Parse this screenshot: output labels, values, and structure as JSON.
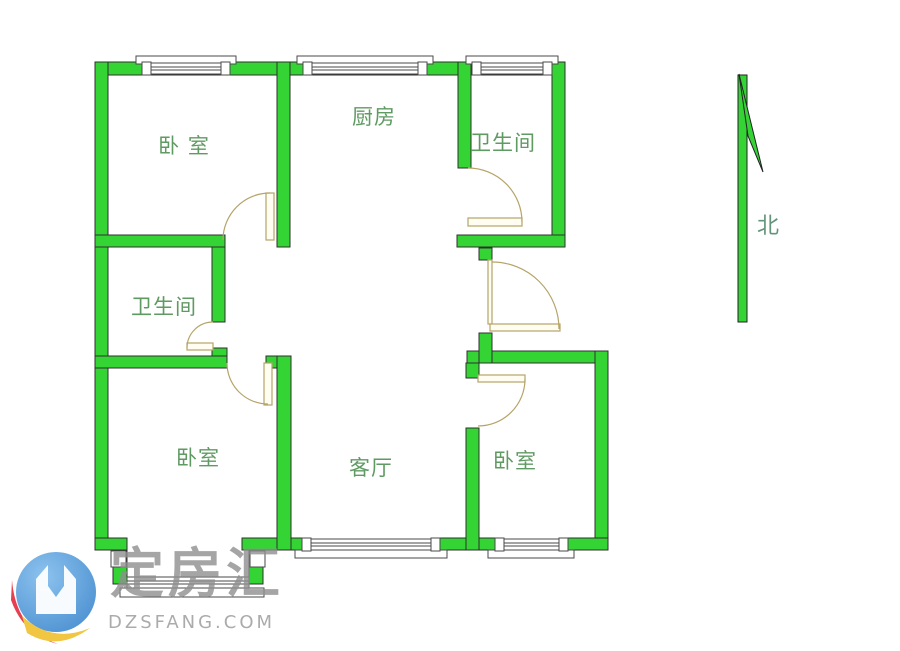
{
  "meta": {
    "title": "apartment-floor-plan",
    "width": 900,
    "height": 651
  },
  "theme": {
    "wall_fill": "#35d435",
    "wall_stroke": "#2f2f2f",
    "door_color": "#b5a468",
    "window_stroke": "#4a4a4a",
    "label_color": "#5f9a62",
    "north_color": "#64947c",
    "logo_blue": "#5b9fd8",
    "logo_blue_light": "#8cc2ee",
    "logo_red": "#e64050",
    "logo_yellow": "#f0c643",
    "watermark_gray": "#8f8f8f"
  },
  "floorplan": {
    "rooms": [
      {
        "id": "bedroom-top-left",
        "label": "卧 室"
      },
      {
        "id": "kitchen",
        "label": "厨房"
      },
      {
        "id": "bathroom-top-right",
        "label": "卫生间"
      },
      {
        "id": "bathroom-mid-left",
        "label": "卫生间"
      },
      {
        "id": "bedroom-bottom-left",
        "label": "卧室"
      },
      {
        "id": "living-room",
        "label": "客厅"
      },
      {
        "id": "bedroom-bottom-right",
        "label": "卧室"
      }
    ],
    "north_label": "北"
  },
  "watermark": {
    "brand": "定房汇",
    "domain": "DZSFANG.COM"
  }
}
